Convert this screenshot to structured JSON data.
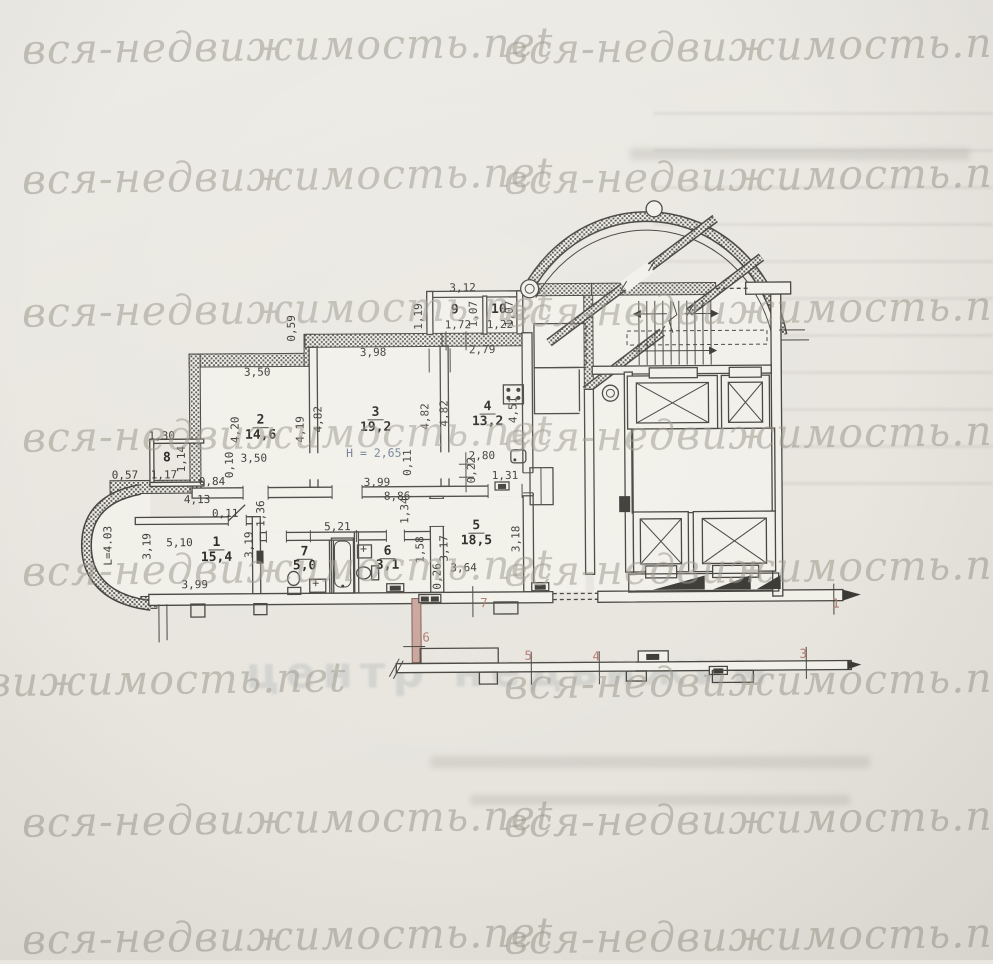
{
  "watermark": {
    "text": "вся-недвижимость.net"
  },
  "bleed_stamp": "центр недвижим",
  "plan": {
    "rooms": [
      {
        "num": "1",
        "area": "15,4"
      },
      {
        "num": "2",
        "area": "14,6"
      },
      {
        "num": "3",
        "area": "19,2"
      },
      {
        "num": "4",
        "area": "13,2"
      },
      {
        "num": "5",
        "area": "18,5"
      },
      {
        "num": "6",
        "area": "3,1"
      },
      {
        "num": "7",
        "area": "5,0"
      },
      {
        "num": "8",
        "area": ""
      },
      {
        "num": "9",
        "area": ""
      },
      {
        "num": "10",
        "area": ""
      }
    ],
    "height_note": "H = 2,65",
    "dims": {
      "annex_w": "3,12",
      "r9_w": "1,72",
      "r10_w": "1,22",
      "r9_h": "1,19",
      "mid_h": "1,07",
      "r10_h": "1,07",
      "below_annex": "2,79",
      "r3_top": "3,98",
      "r2_top": "3,50",
      "jog": "0,59",
      "r2_left": "4,20",
      "r2_right": "4,19",
      "r3_left": "4,82",
      "r3_right": "4,82",
      "r4_left": "4,82",
      "r4_right": "4,51",
      "r2_bot": "3,50",
      "r2_gap": "0,10",
      "b8_top": "1,30",
      "b8_side": "1,14",
      "b8_l": "0,57",
      "b8_b": "1,17",
      "hall_l": "0,84",
      "r3_bot": "3,99",
      "r3_gap": "0,11",
      "r4_bot": "2,80",
      "r4_gap": "0,22",
      "r4_door": "1,31",
      "hall_413": "4,13",
      "hall_011": "0,11",
      "hall_886": "8,86",
      "hall_136": "1,36",
      "hall_134": "1,34",
      "r1_w": "5,10",
      "r1_hl": "3,19",
      "r1_bot": "3,99",
      "r1_hr": "3,19",
      "bay_len": "L=4.03",
      "bath_w": "5,21",
      "r6_h": "1,58",
      "r5_hl": "3,17",
      "r5_wall": "0,26",
      "r5_bot": "3,64",
      "r5_hr": "3,18"
    },
    "axes": {
      "a1": "1",
      "a3": "3",
      "a4": "4",
      "a5": "5",
      "a6": "6",
      "a7": "7"
    }
  }
}
